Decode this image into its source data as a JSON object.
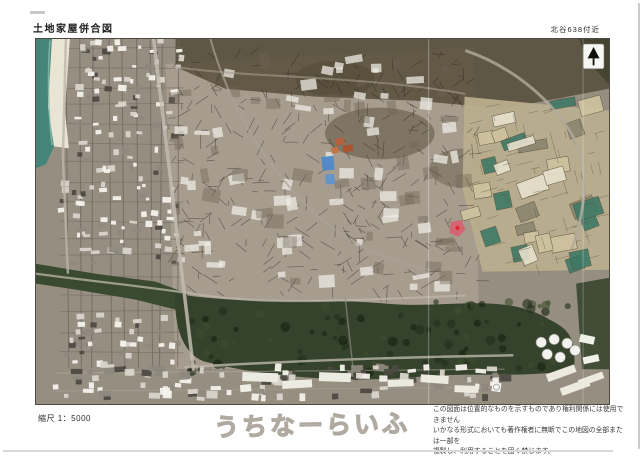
{
  "document": {
    "title": "土地家屋併合図",
    "location_label": "北谷638付近",
    "scale_label": "縮尺 1：5000",
    "watermark": "うちなーらいふ",
    "disclaimer_lines": [
      "この図面は位置的なものを示すものであり権利関係には使用できません",
      "いかなる形式においても著作権者に無断でこの地図の全部または一部を",
      "複製し、利用することを固く禁じます。"
    ]
  },
  "map": {
    "type": "aerial-cadastral-photo",
    "icons": {
      "north_arrow": "▲"
    },
    "colors": {
      "ocean": "#45857a",
      "sand": "#eae4d4",
      "urban_base": "#968e81",
      "center_wash": "#a89f90",
      "vegetation_dark": "#564e3b",
      "field_base": "#b9ae8e",
      "field_beige": "#cfc49e",
      "field_green": "#3f7a66",
      "forest": "#35422c",
      "canal": "#3a4a30",
      "road": "#bdb7ab",
      "parcel_line": "#29231b",
      "building_light": "#f4f2ec",
      "pool_blue": "#4d88c9",
      "roof_orange": "#b5603c",
      "highlight_red": "#d95f72",
      "tank_white": "#f2f2ee"
    }
  }
}
